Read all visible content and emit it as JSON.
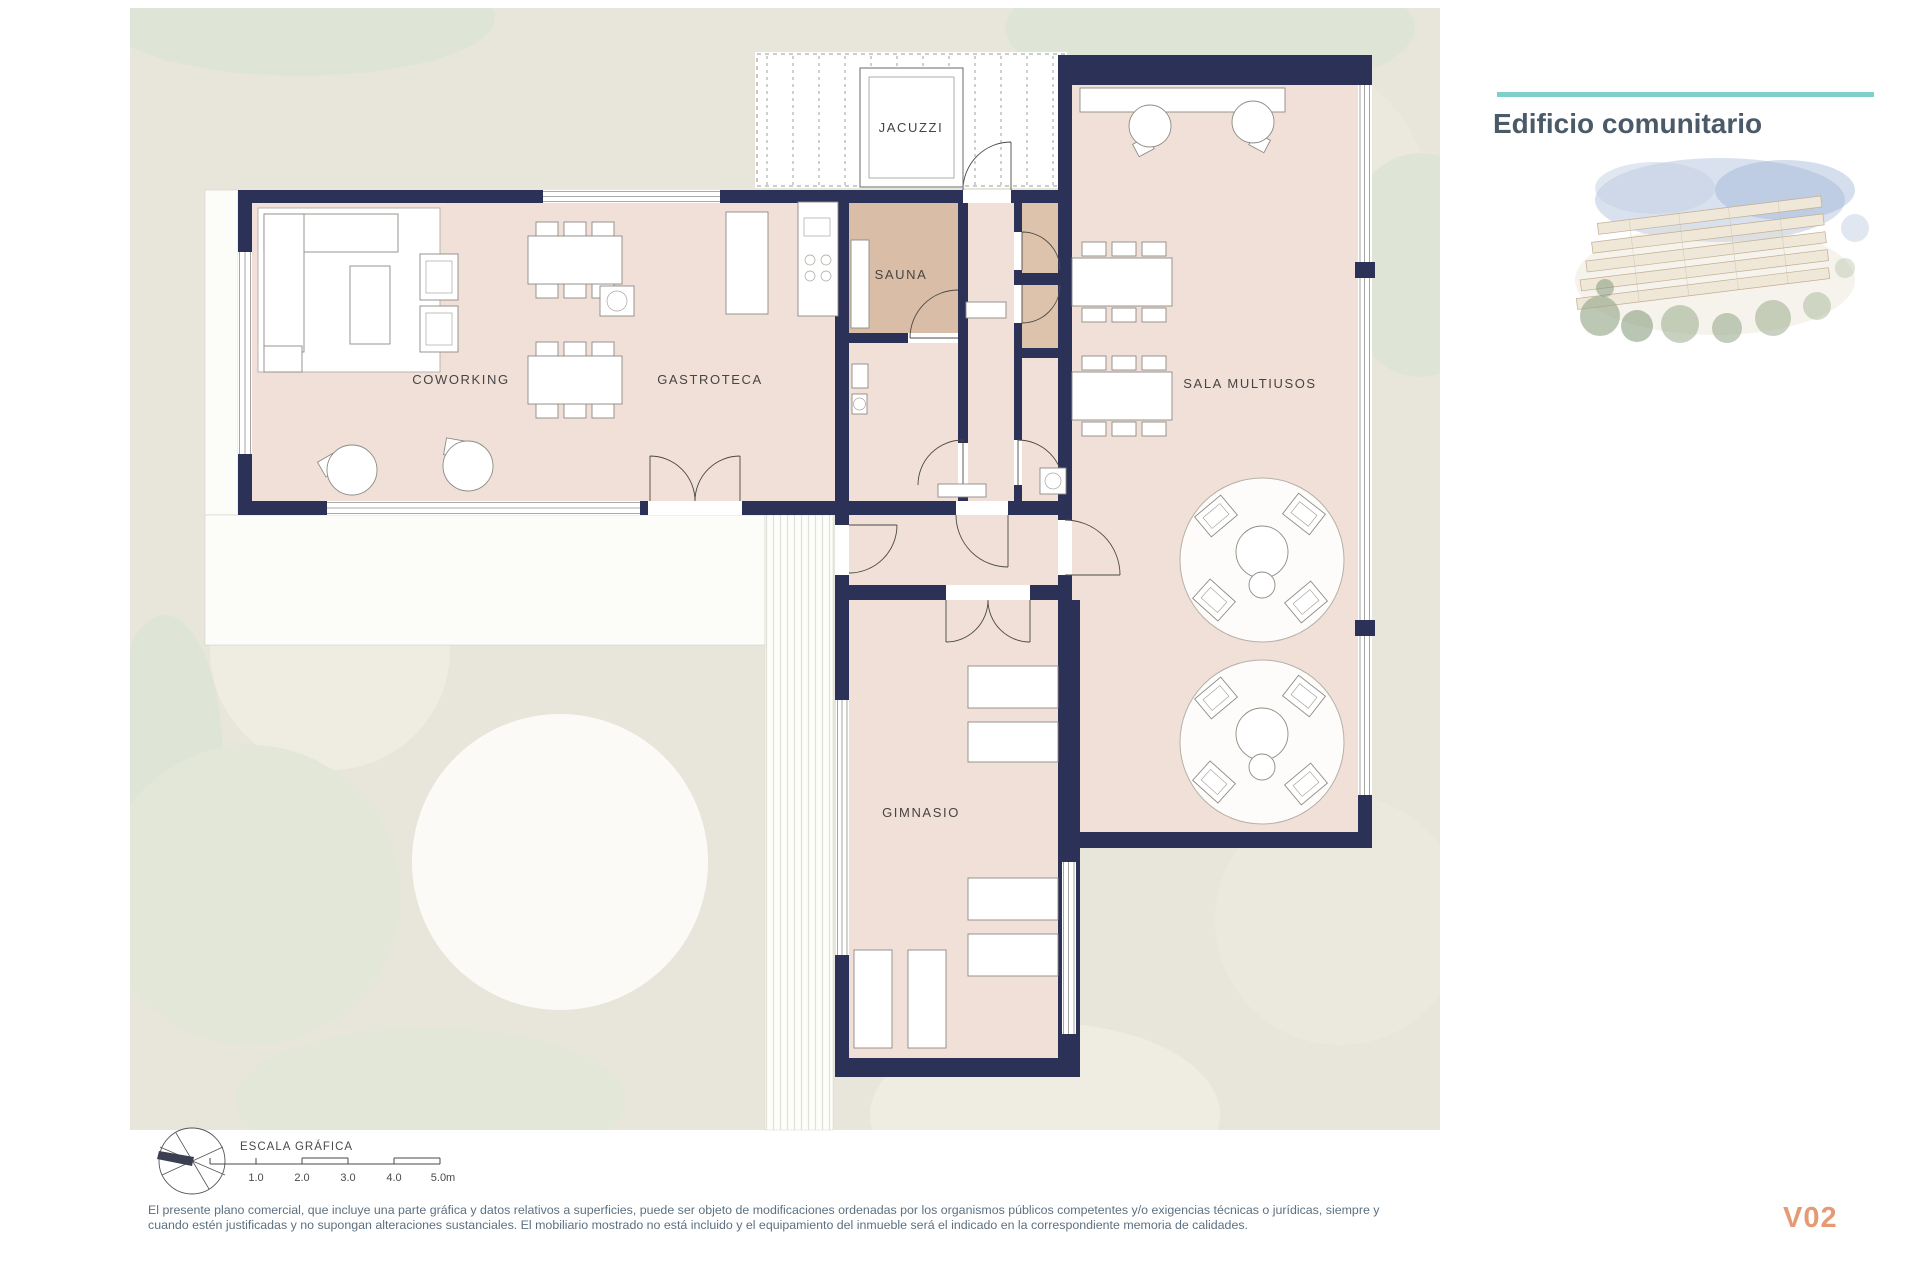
{
  "header": {
    "title": "Edificio comunitario",
    "version_label": "V02"
  },
  "plan": {
    "room_labels": {
      "jacuzzi": "JACUZZI",
      "sauna": "SAUNA",
      "coworking": "COWORKING",
      "gastroteca": "GASTROTECA",
      "sala_multiusos": "SALA MULTIUSOS",
      "gimnasio": "GIMNASIO"
    },
    "colors": {
      "wall": "#2c3157",
      "floor": "#f1e0d7",
      "sauna_floor": "#d9bda6",
      "wc_floor": "#ddc3ac",
      "site": "#e8e6da",
      "greenery": "#dfe5d6",
      "accent": "#7fd0cb",
      "version": "#e69a74"
    }
  },
  "scale_bar": {
    "label": "ESCALA GRÁFICA",
    "ticks": [
      "1.0",
      "2.0",
      "3.0",
      "4.0",
      "5.0m"
    ]
  },
  "disclaimer": {
    "line1": "El presente plano comercial, que incluye una parte gráfica y datos relativos a superficies, puede ser objeto de modificaciones ordenadas por los organismos públicos competentes y/o exigencias técnicas o jurídicas, siempre y",
    "line2": "cuando estén justificadas y no supongan alteraciones sustanciales. El mobiliario mostrado no está incluido y el equipamiento del inmueble será el indicado en la correspondiente memoria de calidades."
  }
}
